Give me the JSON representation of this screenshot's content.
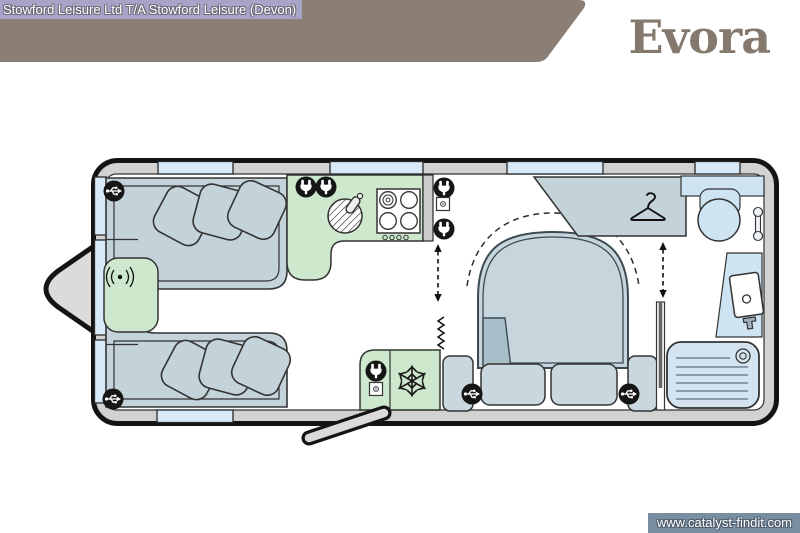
{
  "header": {
    "dealer_text": "Stowford Leisure Ltd T/A Stowford Leisure (Devon)",
    "model_name": "Evora"
  },
  "watermark": {
    "url": "www.catalyst-findit.com"
  },
  "colors": {
    "banner": "#8B7E74",
    "model_text": "#85786D",
    "dealer_badge_bg": "#A7A4C8",
    "watermark_bg": "#7A8EA2",
    "wall": "#D2D2D2",
    "window": "#D8EAF7",
    "sofa": "#C3D3D9",
    "bed": "#C6D6DC",
    "kitchen_unit": "#CDE8CC",
    "bath_fixture": "#CFE4F2",
    "floor": "#FFFFFF",
    "outline": "#1A1A1A"
  },
  "floorplan": {
    "type": "caravan-layout",
    "areas": [
      "front-lounge",
      "kitchen",
      "island-bed-bedroom",
      "washroom"
    ],
    "icon_counts": {
      "usb-socket-icon": 4,
      "mains-plug-socket-icon": 5,
      "switch-icon": 2,
      "scatter-cushions": 6,
      "bed-drawers": 2,
      "windows-top-wall": 4,
      "windows-bottom-wall": 1,
      "windows-front-wall": 3
    },
    "icon_names": [
      "usb-socket-icon",
      "mains-plug-socket-icon",
      "switch-icon",
      "wireless-charging-icon",
      "sink-icon",
      "hob-icon",
      "fridge-snowflake-icon",
      "hanger-icon",
      "basin-icon",
      "toilet-icon",
      "towel-rail-icon",
      "shower-tray-icon",
      "walkway-arrow-icon",
      "entrance-door",
      "hitch"
    ]
  }
}
